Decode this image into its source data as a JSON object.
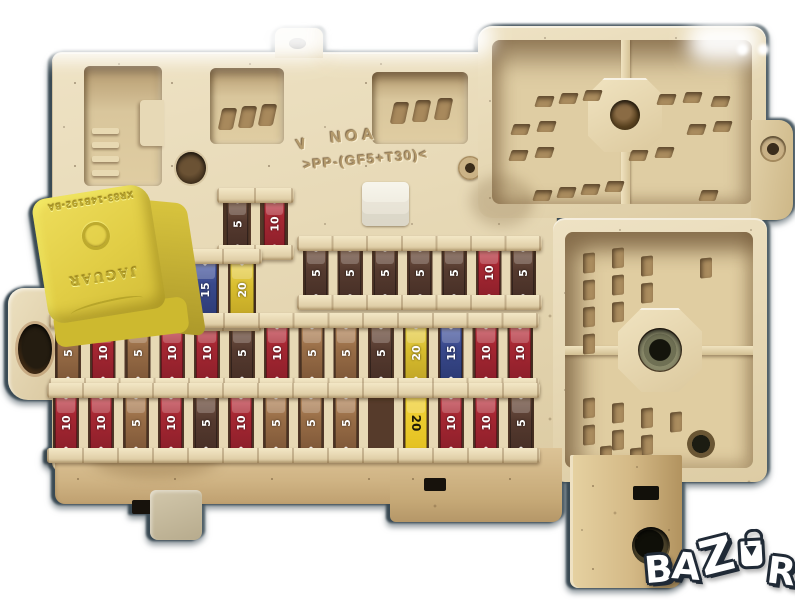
{
  "molded": {
    "mark": "∨",
    "line1": "NOA",
    "line2": ">PP-(GF5+T30)<"
  },
  "relay": {
    "part_number": "XR83-14B192-BA",
    "brand": "JAGUAR",
    "body_color": "#e1cd45"
  },
  "fuses": {
    "palette": {
      "red": "#a82833",
      "tan": "#9a6f48",
      "brown": "#553a2f",
      "blue": "#39498c",
      "yellow": "#d8bd2e",
      "yellowside": "#e8c926"
    },
    "rows": [
      {
        "name": "cluster-top-row",
        "cells": [
          {
            "amp": "5",
            "color": "brown"
          },
          {
            "amp": "10",
            "color": "red"
          }
        ]
      },
      {
        "name": "cluster-bottom-row",
        "cells": [
          {
            "amp": "15",
            "color": "blue"
          },
          {
            "amp": "20",
            "color": "yellow"
          }
        ]
      },
      {
        "name": "upper-row",
        "cells": [
          {
            "amp": "5",
            "color": "brown"
          },
          {
            "amp": "5",
            "color": "brown"
          },
          {
            "amp": "5",
            "color": "brown"
          },
          {
            "amp": "5",
            "color": "brown"
          },
          {
            "amp": "5",
            "color": "brown"
          },
          {
            "amp": "10",
            "color": "red"
          },
          {
            "amp": "5",
            "color": "brown"
          }
        ]
      },
      {
        "name": "middle-row",
        "cells": [
          {
            "amp": "5",
            "color": "tan"
          },
          {
            "amp": "10",
            "color": "red"
          },
          {
            "amp": "5",
            "color": "tan"
          },
          {
            "amp": "10",
            "color": "red"
          },
          {
            "amp": "10",
            "color": "red"
          },
          {
            "amp": "5",
            "color": "brown"
          },
          {
            "amp": "10",
            "color": "red"
          },
          {
            "amp": "5",
            "color": "tan"
          },
          {
            "amp": "5",
            "color": "tan"
          },
          {
            "amp": "5",
            "color": "brown"
          },
          {
            "amp": "20",
            "color": "yellow"
          },
          {
            "amp": "15",
            "color": "blue"
          },
          {
            "amp": "10",
            "color": "red"
          },
          {
            "amp": "10",
            "color": "red"
          }
        ]
      },
      {
        "name": "bottom-row",
        "cells": [
          {
            "amp": "10",
            "color": "red"
          },
          {
            "amp": "10",
            "color": "red"
          },
          {
            "amp": "5",
            "color": "tan"
          },
          {
            "amp": "10",
            "color": "red"
          },
          {
            "amp": "5",
            "color": "brown"
          },
          {
            "amp": "10",
            "color": "red"
          },
          {
            "amp": "5",
            "color": "tan"
          },
          {
            "amp": "5",
            "color": "tan"
          },
          {
            "amp": "5",
            "color": "tan"
          },
          null,
          {
            "amp": "20",
            "color": "yellowside"
          },
          {
            "amp": "10",
            "color": "red"
          },
          {
            "amp": "10",
            "color": "red"
          },
          {
            "amp": "5",
            "color": "brown"
          }
        ]
      }
    ]
  },
  "watermark": {
    "brand": "BAZAR",
    "letters": [
      "B",
      "A",
      "Z",
      "A",
      "R"
    ],
    "logo_fill": "#ffffff",
    "logo_outline": "#202a36"
  }
}
